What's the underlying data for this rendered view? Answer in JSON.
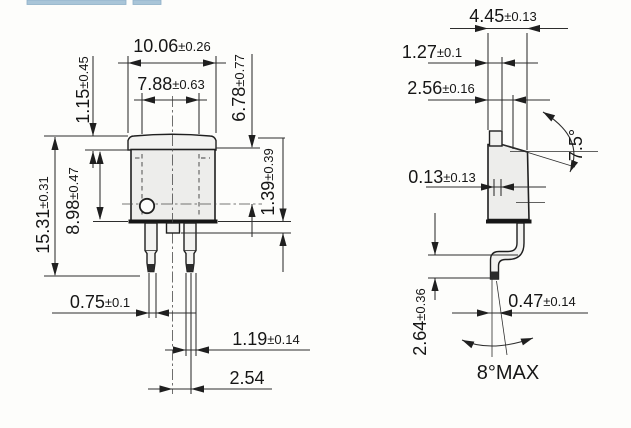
{
  "page": {
    "background": "#fdfdfb"
  },
  "header": {
    "strip_color": "#a9c5d8",
    "strip_border": "#8fb0c8"
  },
  "drawing": {
    "front_view": {
      "tab_width": {
        "v": "10.06",
        "t": "±0.26"
      },
      "body_width": {
        "v": "7.88",
        "t": "±0.63"
      },
      "tab_height": {
        "v": "1.15",
        "t": "±0.45"
      },
      "upper_height": {
        "v": "6.78",
        "t": "±0.77"
      },
      "body_height": {
        "v": "8.98",
        "t": "±0.47"
      },
      "overall_height": {
        "v": "15.31",
        "t": "±0.31"
      },
      "stub_length": {
        "v": "1.39",
        "t": "±0.39"
      },
      "lead_tip_width": {
        "v": "0.75",
        "t": "±0.1"
      },
      "lead_width": {
        "v": "1.19",
        "t": "±0.14"
      },
      "lead_pitch": {
        "v": "2.54",
        "t": ""
      }
    },
    "side_view": {
      "overall_thickness": {
        "v": "4.45",
        "t": "±0.13"
      },
      "tab_thickness": {
        "v": "1.27",
        "t": "±0.1"
      },
      "body_thickness": {
        "v": "2.56",
        "t": "±0.16"
      },
      "standoff": {
        "v": "0.13",
        "t": "±0.13"
      },
      "draft_angle": {
        "v": "7.5°",
        "t": ""
      },
      "lead_thickness": {
        "v": "0.47",
        "t": "±0.14"
      },
      "foot_height": {
        "v": "2.64",
        "t": "±0.36"
      },
      "splay_angle": {
        "v": "8°MAX",
        "t": ""
      }
    },
    "colors": {
      "line": "#2d2d2d",
      "body_fill": "#ededeb",
      "lead_tip_fill": "#2c2c2c"
    }
  }
}
